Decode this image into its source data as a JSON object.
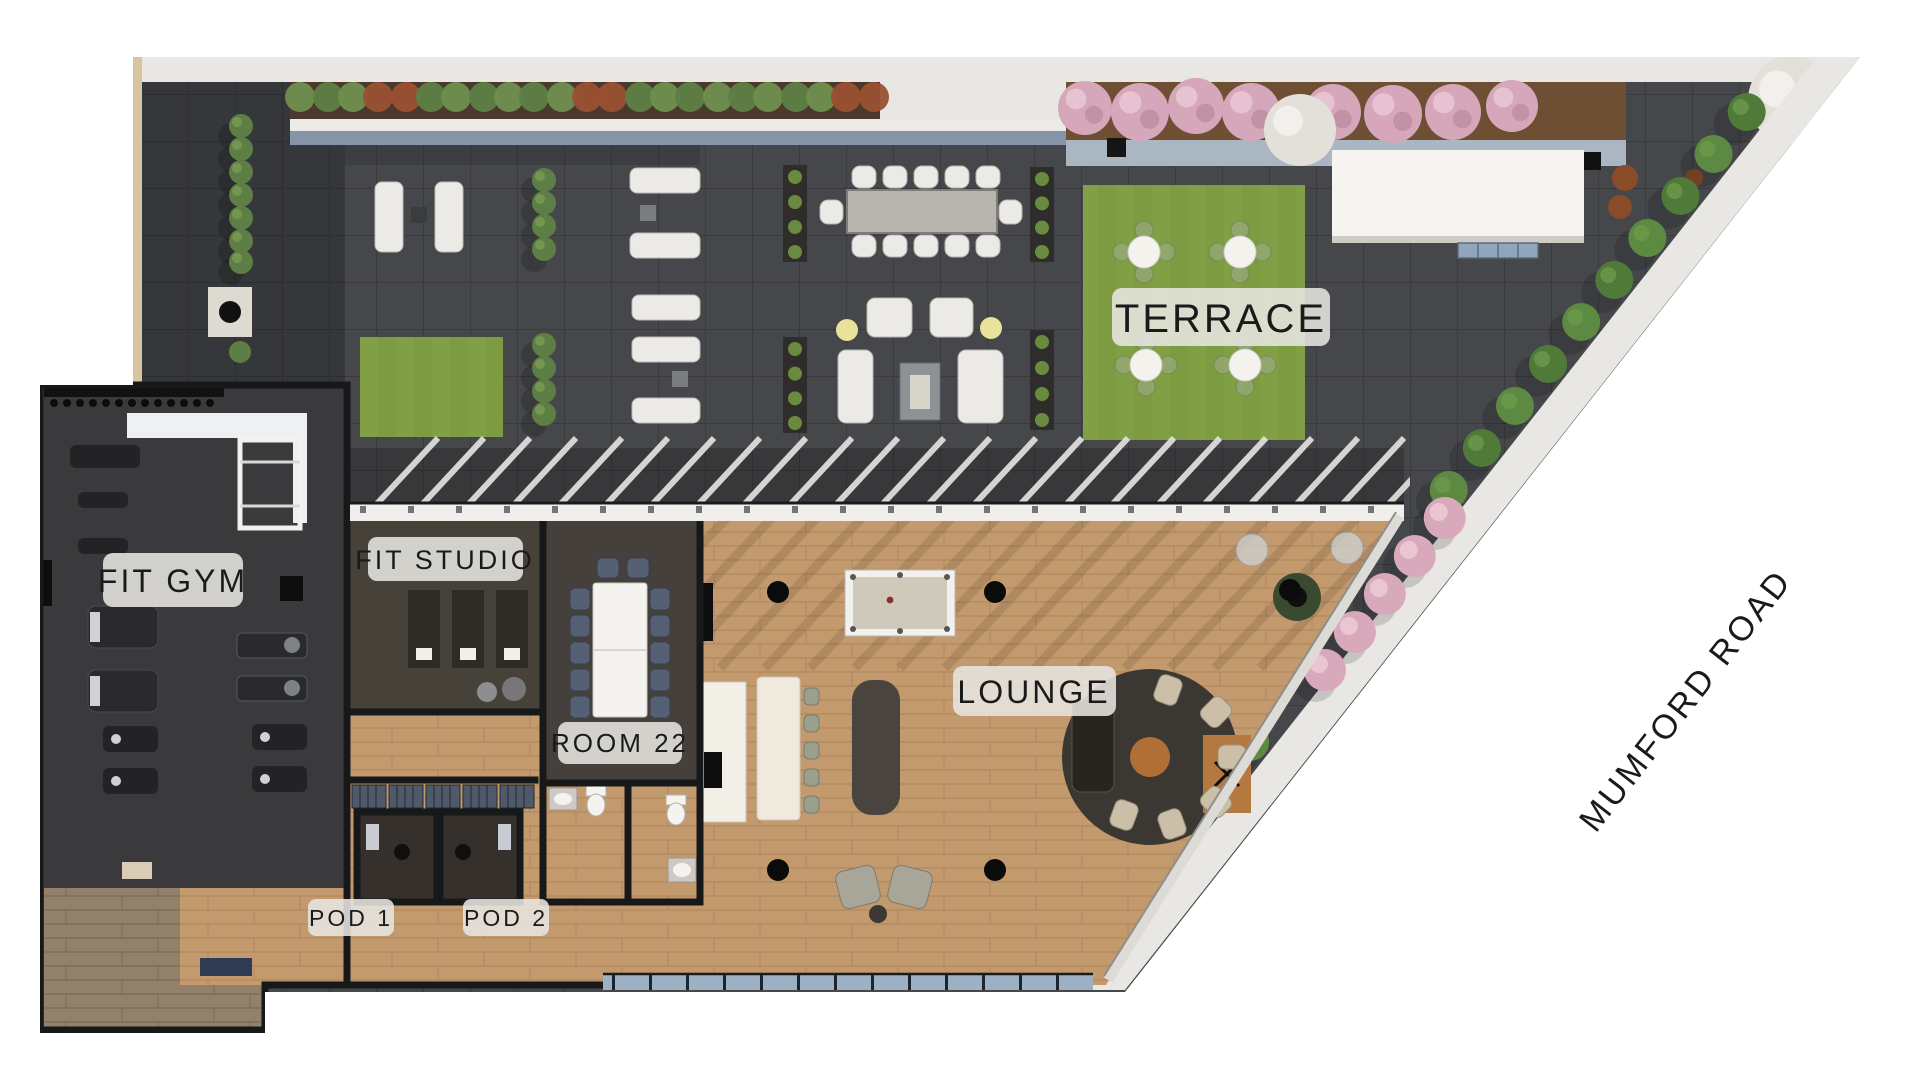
{
  "plan": {
    "title": "Amenity level floor plan",
    "area_labels": {
      "terrace": "TERRACE",
      "fit_gym": "FIT GYM",
      "fit_studio": "FIT STUDIO",
      "room_22": "ROOM 22",
      "lounge": "LOUNGE",
      "pod_1": "POD 1",
      "pod_2": "POD 2"
    },
    "street_label": "MUMFORD ROAD",
    "colors": {
      "background": "#ffffff",
      "paving": "#46474a",
      "paving_shadow": "#2c2e32",
      "sidewalk": "#e9e7e3",
      "soil": "#4a392c",
      "gravel_blue": "#8594a6",
      "lawn": "#7d9c42",
      "hedge_green": "#55813c",
      "pink_tree": "#d6a7ba",
      "white_tree": "#e3e0da",
      "wood_floor": "#c39a6e",
      "wood_floor_dark": "#93806b",
      "gym_floor": "#3a3a3c",
      "studio_floor": "#474239",
      "wall": "#17181a",
      "glass_band": "#f0efec",
      "window_blue": "#9db0c4",
      "white_furniture": "#eceae7",
      "granite_table": "#b7b5ae",
      "dark_furniture": "#4a443e",
      "rug": "#3b3733",
      "wood_accent": "#b06f35",
      "accent_yellow": "#e9e29a",
      "rust_planter": "#8a4b28",
      "label_pill": "#e7e5e0",
      "label_text": "#1a1a1a"
    }
  }
}
